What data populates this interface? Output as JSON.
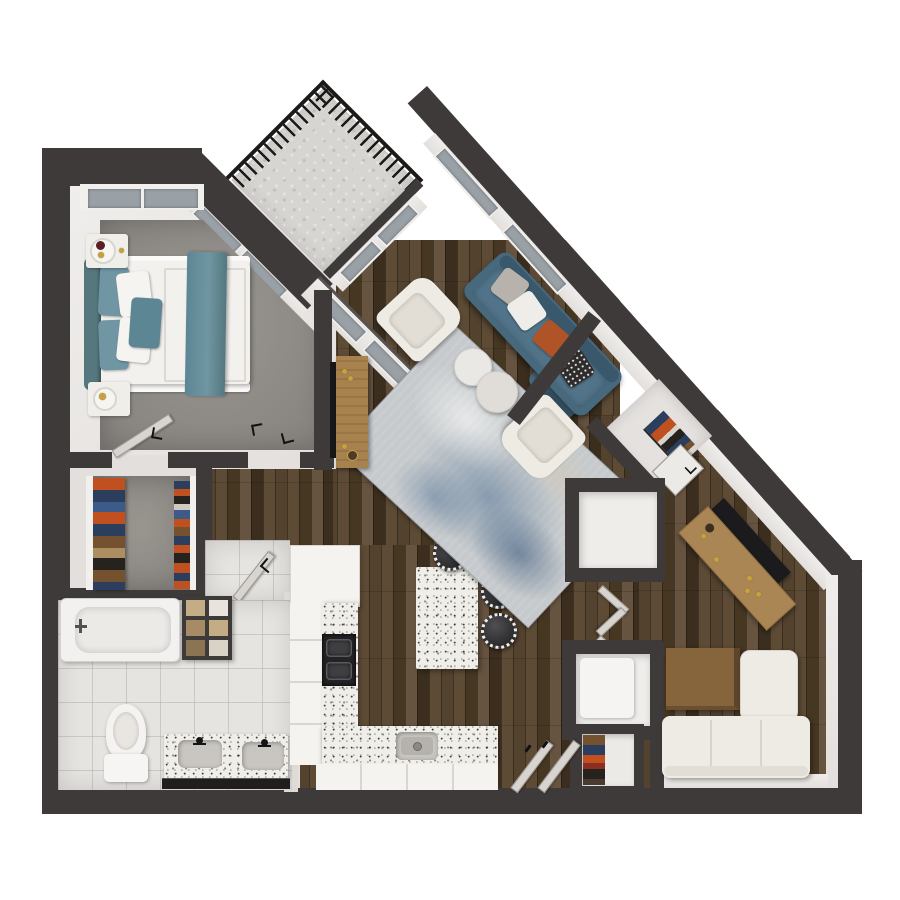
{
  "scene": {
    "kind": "3d-apartment-floor-plan-top-view",
    "canvas": {
      "width": 900,
      "height": 900
    },
    "rooms": [
      "balcony",
      "bedroom",
      "walk-in-closet",
      "bathroom",
      "hallway",
      "kitchen",
      "living-room",
      "entry",
      "coat-closet",
      "utility-closet-upper",
      "utility-closet-lower",
      "linen-closet",
      "den"
    ],
    "furniture": [
      "bed",
      "headboard",
      "teal-pillows",
      "white-pillows",
      "accent-pillow",
      "throw-blanket",
      "nightstand-top",
      "nightstand-bottom",
      "bedroom-windows",
      "hanging-clothes-left",
      "hanging-clothes-right",
      "bathtub",
      "towel-shelf",
      "toilet",
      "double-vanity",
      "vanity-mirror",
      "refrigerator",
      "west-cabinets",
      "west-counter",
      "cooktop",
      "south-counter",
      "kitchen-sink",
      "south-cabinets",
      "kitchen-island",
      "bar-stool-1",
      "bar-stool-2",
      "bar-stool-3",
      "area-rug",
      "blue-sofa",
      "sofa-chaise",
      "armchair-1",
      "armchair-2",
      "coffee-table-1",
      "coffee-table-2",
      "media-console",
      "wall-tv",
      "coat-closet-clothes",
      "bifold-doors",
      "washer-closet",
      "linen-stack",
      "desk",
      "desk-monitor-panel",
      "den-table",
      "sectional-sofa",
      "entry-door-leaves",
      "interior-door-leaves",
      "balcony-railing"
    ]
  },
  "colors": {
    "outside": "#ffffff",
    "wall": "#3e3a39",
    "face": "#e2dfdc",
    "divider": "#dedbd7",
    "glass": "#99a0a6",
    "concrete": "#d7d5d2",
    "railing": "#1b1a19",
    "carpet": "#99958f",
    "carpetDark": "#878playing37f",
    "tile": "#e6e4e1",
    "woodA": "#53422e",
    "woodB": "#5d4b36",
    "woodC": "#463723",
    "woodD": "#665340",
    "woodE": "#3b2e1e",
    "cabinet": "#f4f3f0",
    "cabinetLine": "#d9d6d2",
    "terrazzo": "#f0eee9",
    "stove": "#232325",
    "burner": "#3f3f42",
    "sinkOuter": "#c9c6c1",
    "sinkInner": "#b5b2ad",
    "sofa": "#47697e",
    "sofaDark": "#3a586c",
    "cushionGray": "#b7b3ac",
    "cushionWhite": "#efede9",
    "cushionRust": "#b05327",
    "cushionPattern": "#2e2d2c",
    "cream": "#eeebe4",
    "creamShade": "#d8d4cb",
    "tableWhiteA": "#eae8e4",
    "tableWhiteB": "#e0ddd8",
    "rugBase": "#c6cacc",
    "teal": "#6f96a2",
    "tealDark": "#55787f",
    "tealMid": "#5d8694",
    "duvet": "#f3f1ee",
    "nightstand": "#f0eee9",
    "gold": "#c8a13e",
    "closetOrange": "#c05020",
    "closetNavy": "#2c3e5e",
    "closetBlue": "#3c5b88",
    "closetBrown": "#74522f",
    "closetTan": "#ab8f63",
    "closetBlack": "#26221e",
    "towelA": "#c4ac84",
    "towelB": "#a58c64",
    "tub": "#f3f1ef",
    "mirror": "#201e1d",
    "leaf": "#d8d5d1",
    "leafEdge": "#9a958f",
    "desk": "#ab8655",
    "deskPanel": "#1b1b1e",
    "consoleWood": "#a8824e",
    "tableWood": "#86653c",
    "tableWoodSide": "#5c452a",
    "stoolSeat": "#2c2c2f"
  }
}
